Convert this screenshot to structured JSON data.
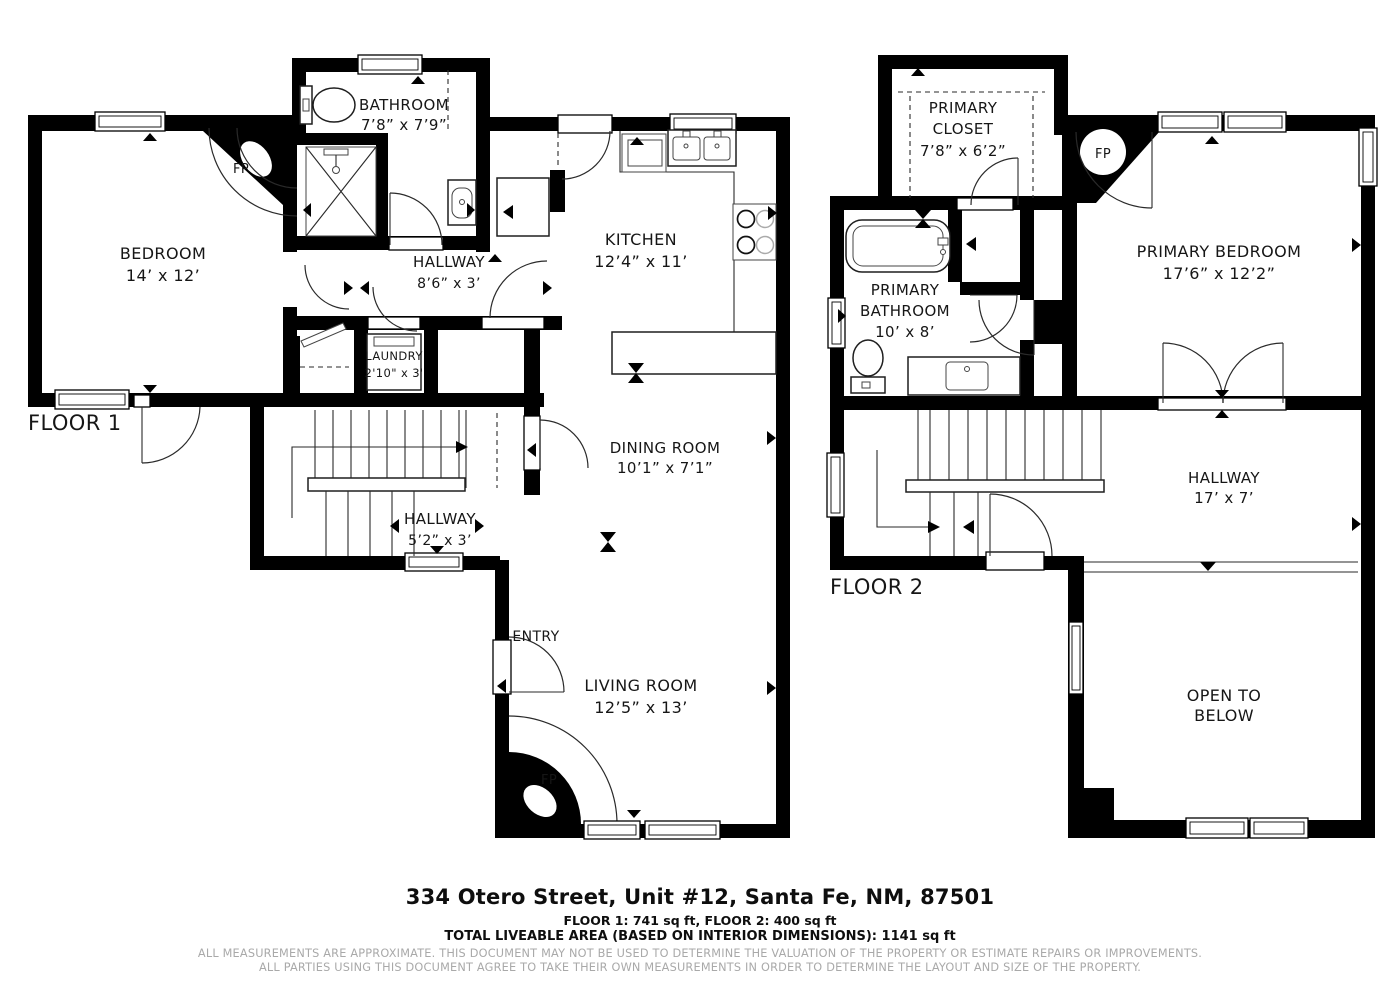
{
  "colors": {
    "wall": "#000000",
    "label_text": "#161616",
    "disclaimer_text": "#a9a9a9",
    "background": "#ffffff"
  },
  "floors": [
    {
      "label": "FLOOR 1",
      "rooms": [
        {
          "id": "bedroom",
          "lines": [
            "BEDROOM",
            "14’ x 12’"
          ]
        },
        {
          "id": "bathroom",
          "lines": [
            "BATHROOM",
            "7’8” x 7’9”"
          ]
        },
        {
          "id": "hallway-upper",
          "lines": [
            "HALLWAY",
            "8’6” x 3’"
          ]
        },
        {
          "id": "kitchen",
          "lines": [
            "KITCHEN",
            "12’4” x 11’"
          ]
        },
        {
          "id": "laundry",
          "lines": [
            "LAUNDRY",
            "2'10\" x 3'"
          ]
        },
        {
          "id": "dining-room",
          "lines": [
            "DINING ROOM",
            "10’1” x 7’1”"
          ]
        },
        {
          "id": "hallway-lower",
          "lines": [
            "HALLWAY",
            "5’2” x 3’"
          ]
        },
        {
          "id": "entry",
          "lines": [
            "ENTRY"
          ]
        },
        {
          "id": "living-room",
          "lines": [
            "LIVING ROOM",
            "12’5” x 13’"
          ]
        }
      ],
      "fireplaces": [
        "FP",
        "FP"
      ]
    },
    {
      "label": "FLOOR 2",
      "rooms": [
        {
          "id": "primary-closet",
          "lines": [
            "PRIMARY",
            "CLOSET",
            "7’8” x 6’2”"
          ]
        },
        {
          "id": "primary-bathroom",
          "lines": [
            "PRIMARY",
            "BATHROOM",
            "10’ x 8’"
          ]
        },
        {
          "id": "primary-bedroom",
          "lines": [
            "PRIMARY BEDROOM",
            "17’6” x 12’2”"
          ]
        },
        {
          "id": "hallway",
          "lines": [
            "HALLWAY",
            "17’ x 7’"
          ]
        },
        {
          "id": "open-to-below",
          "lines": [
            "OPEN TO",
            "BELOW"
          ]
        }
      ],
      "fireplaces": [
        "FP"
      ]
    }
  ],
  "footer": {
    "address": "334 Otero Street, Unit #12, Santa Fe, NM, 87501",
    "floor_areas": "FLOOR 1: 741 sq ft, FLOOR 2: 400 sq ft",
    "total_area": "TOTAL LIVEABLE AREA (BASED ON INTERIOR DIMENSIONS): 1141 sq ft",
    "disclaimer_line1": "ALL MEASUREMENTS ARE APPROXIMATE. THIS DOCUMENT MAY NOT BE USED TO DETERMINE THE VALUATION OF THE PROPERTY OR ESTIMATE REPAIRS OR IMPROVEMENTS.",
    "disclaimer_line2": "ALL PARTIES USING THIS DOCUMENT AGREE TO TAKE THEIR OWN MEASUREMENTS IN ORDER TO DETERMINE THE LAYOUT AND SIZE OF THE PROPERTY."
  }
}
